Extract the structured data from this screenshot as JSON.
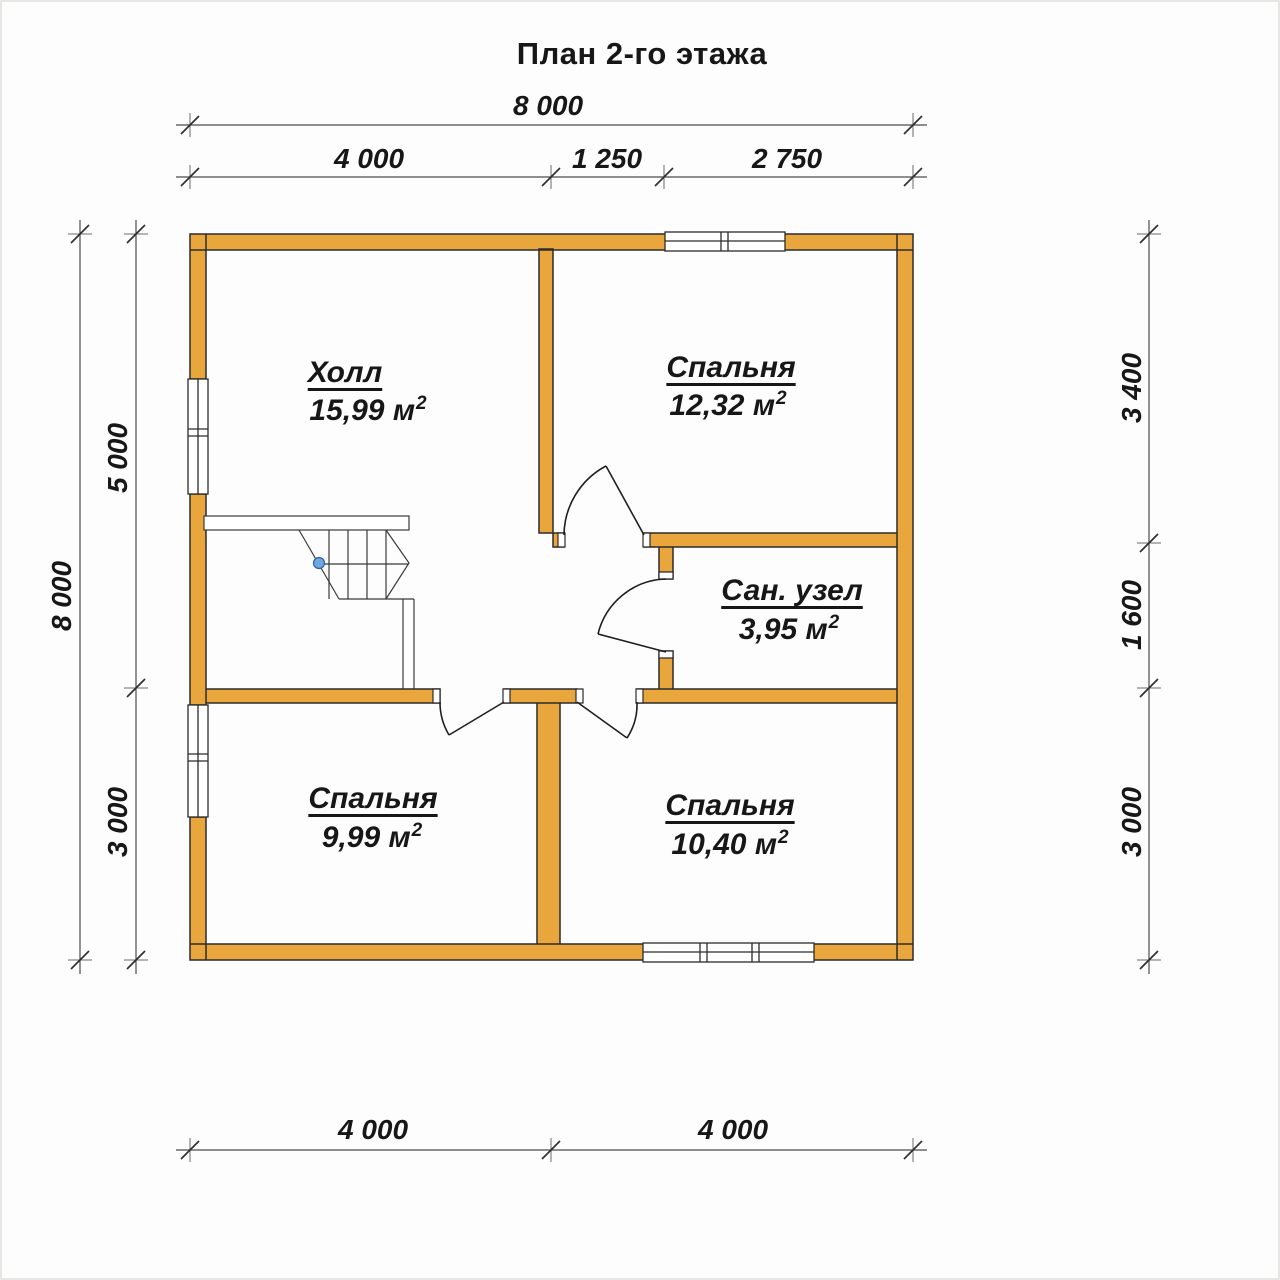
{
  "title": "План 2-го этажа",
  "colors": {
    "wall": "#E8A63C",
    "outline": "#2B2B2B",
    "dim_line": "#4D4D4D",
    "stair_dot": "#6FA8DC"
  },
  "rooms": [
    {
      "name": "Холл",
      "area": "15,99 м",
      "area_sup": "2"
    },
    {
      "name": "Спальня",
      "area": "12,32 м",
      "area_sup": "2"
    },
    {
      "name": "Сан. узел",
      "area": "3,95 м",
      "area_sup": "2"
    },
    {
      "name": "Спальня",
      "area": "9,99 м",
      "area_sup": "2"
    },
    {
      "name": "Спальня",
      "area": "10,40 м",
      "area_sup": "2"
    }
  ],
  "dimensions": {
    "top_total": "8 000",
    "top_segments": [
      "4 000",
      "1 250",
      "2 750"
    ],
    "bottom_segments": [
      "4 000",
      "4 000"
    ],
    "left_total": "8 000",
    "left_segments": [
      "5 000",
      "3 000"
    ],
    "right_segments": [
      "3 400",
      "1 600",
      "3 000"
    ]
  }
}
